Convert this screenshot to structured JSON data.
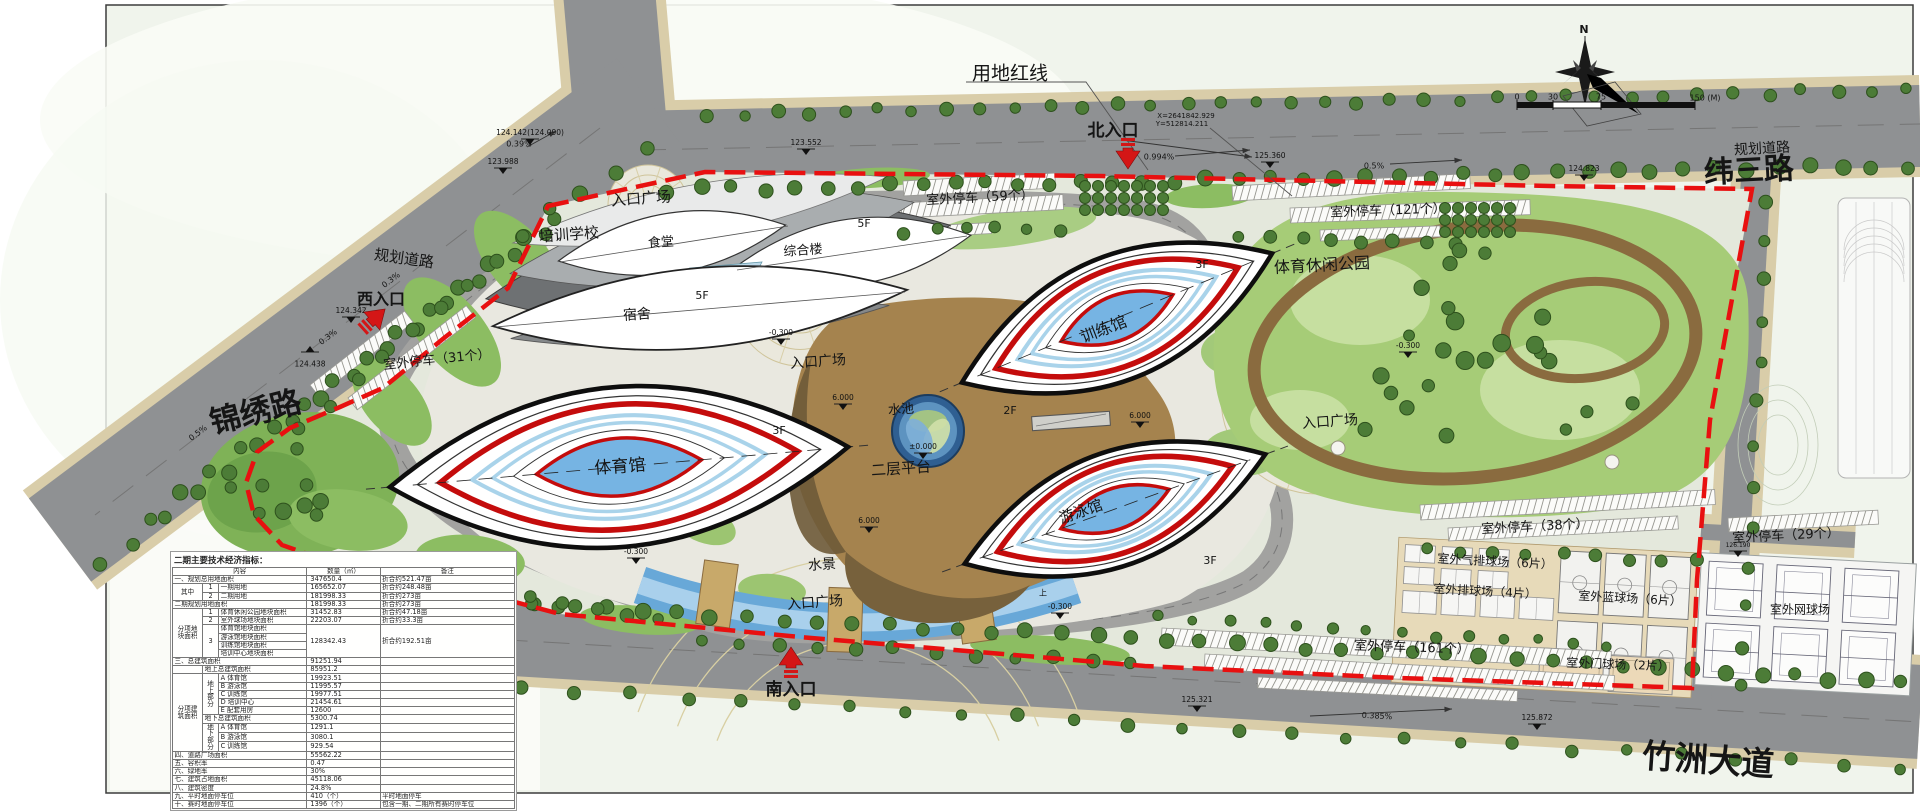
{
  "colors": {
    "boundary_red": "#e81010",
    "venue_red": "#c40c0c",
    "water_blue": "#76b4e3",
    "park_green": "#a6cc77",
    "road_gray": "#8f9193",
    "platform_brown": "#a5834e"
  },
  "map_labels": [
    {
      "n": "site-boundary-label",
      "t": "用地红线",
      "x": 1010,
      "y": 74,
      "s": 19
    },
    {
      "n": "north-entrance-label",
      "t": "北入口",
      "x": 1113,
      "y": 131,
      "s": 17,
      "w": "bold"
    },
    {
      "n": "coordinate-x",
      "t": "X=2641842.929",
      "x": 1186,
      "y": 116,
      "s": 7
    },
    {
      "n": "coordinate-y",
      "t": "Y=512814.211",
      "x": 1182,
      "y": 124,
      "s": 7
    },
    {
      "n": "slope-north",
      "t": "0.994%",
      "x": 1159,
      "y": 157,
      "s": 8
    },
    {
      "n": "road-weisan",
      "t": "纬三路",
      "x": 1749,
      "y": 172,
      "s": 30,
      "w": "bold",
      "r": -3
    },
    {
      "n": "road-planned-ne",
      "t": "规划道路",
      "x": 1762,
      "y": 149,
      "s": 14,
      "r": -3
    },
    {
      "n": "road-jinxiu",
      "t": "锦绣路",
      "x": 256,
      "y": 414,
      "s": 31,
      "w": "bold",
      "r": -14
    },
    {
      "n": "road-planned-w",
      "t": "规划道路",
      "x": 404,
      "y": 259,
      "s": 15,
      "r": 8
    },
    {
      "n": "road-zhuzhou",
      "t": "竹洲大道",
      "x": 1708,
      "y": 762,
      "s": 33,
      "w": "bold",
      "r": 4
    },
    {
      "n": "west-entrance-label",
      "t": "西入口",
      "x": 381,
      "y": 300,
      "s": 16,
      "w": "bold"
    },
    {
      "n": "south-entrance-label",
      "t": "南入口",
      "x": 791,
      "y": 690,
      "s": 17,
      "w": "bold"
    },
    {
      "n": "plaza-northwest-label",
      "t": "入口广场",
      "x": 641,
      "y": 199,
      "s": 15,
      "r": -4
    },
    {
      "n": "plaza-middle-label",
      "t": "入口广场",
      "x": 818,
      "y": 362,
      "s": 14,
      "r": -4
    },
    {
      "n": "plaza-east-label",
      "t": "入口广场",
      "x": 1330,
      "y": 422,
      "s": 14,
      "r": -4
    },
    {
      "n": "plaza-south-label",
      "t": "入口广场",
      "x": 815,
      "y": 603,
      "s": 14,
      "r": -4
    },
    {
      "n": "training-school-label",
      "t": "培训学校",
      "x": 569,
      "y": 235,
      "s": 15,
      "r": -4
    },
    {
      "n": "canteen-label",
      "t": "食堂",
      "x": 661,
      "y": 243,
      "s": 13,
      "r": -4
    },
    {
      "n": "complex-building-label",
      "t": "综合楼",
      "x": 803,
      "y": 251,
      "s": 13,
      "r": -4
    },
    {
      "n": "dormitory-label",
      "t": "宿舍",
      "x": 637,
      "y": 315,
      "s": 14,
      "r": -4
    },
    {
      "n": "floor-5f-dorm",
      "t": "5F",
      "x": 702,
      "y": 296,
      "s": 11
    },
    {
      "n": "floor-5f-complex",
      "t": "5F",
      "x": 864,
      "y": 224,
      "s": 11
    },
    {
      "n": "gymnasium-label",
      "t": "体育馆",
      "x": 620,
      "y": 467,
      "s": 17,
      "r": -4
    },
    {
      "n": "training-hall-label",
      "t": "训练馆",
      "x": 1104,
      "y": 330,
      "s": 16,
      "r": -21
    },
    {
      "n": "swimming-hall-label",
      "t": "游泳馆",
      "x": 1081,
      "y": 512,
      "s": 15,
      "r": -19
    },
    {
      "n": "platform-label",
      "t": "二层平台",
      "x": 901,
      "y": 469,
      "s": 15,
      "r": -4
    },
    {
      "n": "pool-label",
      "t": "水池",
      "x": 901,
      "y": 410,
      "s": 13,
      "r": -4
    },
    {
      "n": "waterscape-label",
      "t": "水景",
      "x": 822,
      "y": 565,
      "s": 14,
      "r": -4
    },
    {
      "n": "leisure-park-label",
      "t": "体育休闲公园",
      "x": 1322,
      "y": 266,
      "s": 16,
      "r": -3
    },
    {
      "n": "parking-59-label",
      "t": "室外停车（59个）",
      "x": 980,
      "y": 198,
      "s": 13,
      "r": -3
    },
    {
      "n": "parking-121-label",
      "t": "室外停车（121个）",
      "x": 1388,
      "y": 211,
      "s": 13,
      "r": -2
    },
    {
      "n": "parking-31-label",
      "t": "室外停车（31个）",
      "x": 437,
      "y": 360,
      "s": 13,
      "r": -6
    },
    {
      "n": "parking-38-label",
      "t": "室外停车（38个）",
      "x": 1535,
      "y": 527,
      "s": 13,
      "r": -3
    },
    {
      "n": "parking-29-label",
      "t": "室外停车（29个）",
      "x": 1786,
      "y": 536,
      "s": 13,
      "r": -3
    },
    {
      "n": "parking-161-label",
      "t": "室外停车（161个）",
      "x": 1412,
      "y": 648,
      "s": 13,
      "r": 2
    },
    {
      "n": "air-volleyball-label",
      "t": "室外气排球场（6片）",
      "x": 1495,
      "y": 562,
      "s": 12,
      "r": 3
    },
    {
      "n": "volleyball-label",
      "t": "室外排球场（4片）",
      "x": 1485,
      "y": 592,
      "s": 12,
      "r": 3
    },
    {
      "n": "basketball-label",
      "t": "室外蓝球场（6片）",
      "x": 1630,
      "y": 599,
      "s": 12,
      "r": 3
    },
    {
      "n": "gateball-label",
      "t": "室外门球场（2片）",
      "x": 1618,
      "y": 665,
      "s": 12,
      "r": 2
    },
    {
      "n": "tennis-label",
      "t": "室外网球场",
      "x": 1800,
      "y": 610,
      "s": 12
    },
    {
      "n": "floor-3f-gym",
      "t": "3F",
      "x": 779,
      "y": 431,
      "s": 11
    },
    {
      "n": "floor-3f-training",
      "t": "3F",
      "x": 1202,
      "y": 265,
      "s": 11
    },
    {
      "n": "floor-3f-swim",
      "t": "3F",
      "x": 1210,
      "y": 561,
      "s": 11
    },
    {
      "n": "floor-2f-platform",
      "t": "2F",
      "x": 1010,
      "y": 411,
      "s": 11
    },
    {
      "n": "slope-top-east",
      "t": "0.5%",
      "x": 1374,
      "y": 166,
      "s": 8
    },
    {
      "n": "slope-topleft",
      "t": "0.39%",
      "x": 519,
      "y": 144,
      "s": 8
    },
    {
      "n": "slope-west-a",
      "t": "0.3%",
      "x": 391,
      "y": 280,
      "s": 8,
      "r": -37
    },
    {
      "n": "slope-west-b",
      "t": "0.3%",
      "x": 328,
      "y": 337,
      "s": 8,
      "r": -37
    },
    {
      "n": "slope-jinxiu",
      "t": "0.5%",
      "x": 198,
      "y": 433,
      "s": 8,
      "r": -37
    },
    {
      "n": "slope-south",
      "t": "0.385%",
      "x": 1377,
      "y": 716,
      "s": 8,
      "r": 3
    },
    {
      "n": "compass-n-label",
      "t": "N",
      "x": 1584,
      "y": 30,
      "s": 11,
      "w": "bold"
    },
    {
      "n": "scale-tick-0",
      "t": "0",
      "x": 1517,
      "y": 97,
      "s": 8
    },
    {
      "n": "scale-tick-30",
      "t": "30",
      "x": 1553,
      "y": 97,
      "s": 8
    },
    {
      "n": "scale-tick-75",
      "t": "75",
      "x": 1601,
      "y": 97,
      "s": 8
    },
    {
      "n": "scale-tick-150",
      "t": "150 (M)",
      "x": 1705,
      "y": 98,
      "s": 8
    },
    {
      "n": "stair-up-mark",
      "t": "上",
      "x": 1043,
      "y": 593,
      "s": 8
    }
  ],
  "elevation_marks": [
    {
      "t": "124.142(124.090)",
      "x": 530,
      "y": 139
    },
    {
      "t": "123.988",
      "x": 503,
      "y": 168
    },
    {
      "t": "123.552",
      "x": 806,
      "y": 149
    },
    {
      "t": "125.360",
      "x": 1270,
      "y": 162
    },
    {
      "t": "124.823",
      "x": 1584,
      "y": 175
    },
    {
      "t": "124.342",
      "x": 351,
      "y": 317
    },
    {
      "t": "124.438",
      "x": 310,
      "y": 352,
      "d": "u"
    },
    {
      "t": "125.321",
      "x": 1197,
      "y": 706
    },
    {
      "t": "125.872",
      "x": 1537,
      "y": 724
    },
    {
      "t": "6.000",
      "x": 843,
      "y": 404
    },
    {
      "t": "6.000",
      "x": 1140,
      "y": 422
    },
    {
      "t": "6.000",
      "x": 869,
      "y": 527
    },
    {
      "t": "±0.000",
      "x": 923,
      "y": 453
    },
    {
      "t": "-0.300",
      "x": 781,
      "y": 339
    },
    {
      "t": "-0.300",
      "x": 636,
      "y": 558
    },
    {
      "t": "-0.300",
      "x": 1060,
      "y": 613
    },
    {
      "t": "-0.300",
      "x": 1408,
      "y": 352
    },
    {
      "t": "126.190",
      "x": 1738,
      "y": 551,
      "s": 6
    }
  ],
  "entrances": [
    {
      "n": "north-entrance-arrow",
      "x": 1128,
      "y": 154,
      "r": 180
    },
    {
      "n": "west-entrance-arrow",
      "x": 374,
      "y": 319,
      "r": 48
    },
    {
      "n": "south-entrance-arrow",
      "x": 791,
      "y": 662,
      "r": 0
    }
  ],
  "table": {
    "title": "二期主要技术经济指标：",
    "col_widths": [
      30,
      16,
      88,
      73,
      134
    ],
    "rows": [
      [
        {
          "t": "内容",
          "c": 3,
          "k": "c"
        },
        {
          "t": "数量（㎡）",
          "k": "c"
        },
        {
          "t": "备注",
          "k": "c"
        }
      ],
      [
        {
          "t": "一、规划总用地面积",
          "c": 3
        },
        {
          "t": "347650.4",
          "k": "n"
        },
        {
          "t": "折合约521.47亩"
        }
      ],
      [
        {
          "t": "其中",
          "r": 2,
          "k": "c"
        },
        {
          "t": "1",
          "k": "c"
        },
        {
          "t": "一期用地"
        },
        {
          "t": "165652.07",
          "k": "n"
        },
        {
          "t": "折合约248.48亩"
        }
      ],
      [
        {
          "t": "2",
          "k": "c"
        },
        {
          "t": "二期用地"
        },
        {
          "t": "181998.33",
          "k": "n"
        },
        {
          "t": "折合约273亩"
        }
      ],
      [
        {
          "t": "二期规划用地面积",
          "c": 3
        },
        {
          "t": "181998.33",
          "k": "n"
        },
        {
          "t": "折合约273亩"
        }
      ],
      [
        {
          "t": "分项地块面积",
          "r": 6,
          "k": "g"
        },
        {
          "t": "1",
          "k": "c"
        },
        {
          "t": "体育休闲公园地块面积"
        },
        {
          "t": "31452.83",
          "k": "n"
        },
        {
          "t": "折合约47.18亩"
        }
      ],
      [
        {
          "t": "2",
          "k": "c"
        },
        {
          "t": "室外球场地块面积"
        },
        {
          "t": "22203.07",
          "k": "n"
        },
        {
          "t": "折合约33.3亩"
        }
      ],
      [
        {
          "t": "3",
          "r": 4,
          "k": "c"
        },
        {
          "t": "体育馆地块面积"
        },
        {
          "t": "128342.43",
          "r": 4,
          "k": "n"
        },
        {
          "t": "折合约192.51亩",
          "r": 4
        }
      ],
      [
        {
          "t": "游泳馆地块面积"
        }
      ],
      [
        {
          "t": "训练馆地块面积"
        }
      ],
      [
        {
          "t": "培训中心地块面积"
        }
      ],
      [
        {
          "t": "三、总建筑面积",
          "c": 3
        },
        {
          "t": "91251.94",
          "k": "n"
        },
        {
          "t": ""
        }
      ],
      [
        {
          "t": ""
        },
        {
          "t": "地上总建筑面积",
          "c": 2
        },
        {
          "t": "85951.2",
          "k": "n"
        },
        {
          "t": ""
        }
      ],
      [
        {
          "t": "分项建筑面积",
          "r": 9,
          "k": "g"
        },
        {
          "t": "地上部分",
          "r": 5,
          "k": "g"
        },
        {
          "t": "A 体育馆"
        },
        {
          "t": "19923.51",
          "k": "n"
        },
        {
          "t": ""
        }
      ],
      [
        {
          "t": "B 游泳馆"
        },
        {
          "t": "11995.57",
          "k": "n"
        },
        {
          "t": ""
        }
      ],
      [
        {
          "t": "C 训练馆"
        },
        {
          "t": "19977.51",
          "k": "n"
        },
        {
          "t": ""
        }
      ],
      [
        {
          "t": "D 培训中心"
        },
        {
          "t": "21454.61",
          "k": "n"
        },
        {
          "t": ""
        }
      ],
      [
        {
          "t": "E 配套用房"
        },
        {
          "t": "12600",
          "k": "n"
        },
        {
          "t": ""
        }
      ],
      [
        {
          "t": "地下总建筑面积",
          "c": 2
        },
        {
          "t": "5300.74",
          "k": "n"
        },
        {
          "t": ""
        }
      ],
      [
        {
          "t": "地下部分",
          "r": 3,
          "k": "g"
        },
        {
          "t": "A 体育馆"
        },
        {
          "t": "1291.1",
          "k": "n"
        },
        {
          "t": ""
        }
      ],
      [
        {
          "t": "B 游泳馆"
        },
        {
          "t": "3080.1",
          "k": "n"
        },
        {
          "t": ""
        }
      ],
      [
        {
          "t": "C 训练馆"
        },
        {
          "t": "929.54",
          "k": "n"
        },
        {
          "t": ""
        }
      ],
      [
        {
          "t": "四、道路广场面积",
          "c": 3
        },
        {
          "t": "55562.22",
          "k": "n"
        },
        {
          "t": ""
        }
      ],
      [
        {
          "t": "五、容积率",
          "c": 3
        },
        {
          "t": "0.47",
          "k": "n"
        },
        {
          "t": ""
        }
      ],
      [
        {
          "t": "六、绿地率",
          "c": 3
        },
        {
          "t": "30%",
          "k": "n"
        },
        {
          "t": ""
        }
      ],
      [
        {
          "t": "七、建筑占地面积",
          "c": 3
        },
        {
          "t": "45118.06",
          "k": "n"
        },
        {
          "t": ""
        }
      ],
      [
        {
          "t": "八、建筑密度",
          "c": 3
        },
        {
          "t": "24.8%",
          "k": "n"
        },
        {
          "t": ""
        }
      ],
      [
        {
          "t": "九、平时地面停车位",
          "c": 3
        },
        {
          "t": "410（个）",
          "k": "n"
        },
        {
          "t": "平时地面停车"
        }
      ],
      [
        {
          "t": "十、赛时地面停车位",
          "c": 3
        },
        {
          "t": "1396（个）",
          "k": "n"
        },
        {
          "t": "包含一期、二期所有赛时停车位"
        }
      ]
    ]
  }
}
